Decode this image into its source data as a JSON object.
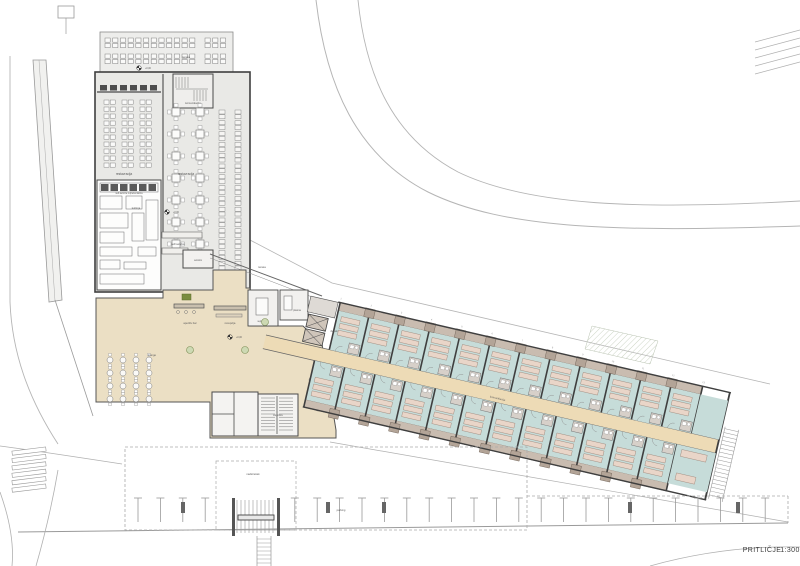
{
  "drawing": {
    "title": "PRITLIČJE",
    "scale": "1:300"
  },
  "labels": {
    "terrace_top": "terasa",
    "stairs": "komunikacija",
    "restaurant_left": "restavracija",
    "restaurant_right": "restavracija",
    "self_service_counter": "self-service reprezentanca",
    "kitchen": "kuhinja",
    "self_service": "self-service",
    "windbreak": "vetrolov",
    "terrace_small": "terasa",
    "meeting_room": "sejna soba",
    "office": "pisarna",
    "elevator": "dvigalo",
    "aperitif_bar": "aperitiv bar",
    "reception": "recepcija",
    "lounge": "lounge",
    "staircase": "stopnišče",
    "corridor": "komunikacija",
    "parking": "parking",
    "canopy": "nadstrešek",
    "elevation_marker": "+0,00"
  },
  "axis_numbers": [
    "1",
    "2",
    "3",
    "4",
    "5",
    "6",
    "7",
    "8",
    "9",
    "10",
    "11",
    "12",
    "13"
  ],
  "wing": {
    "rooms_top": 12,
    "rooms_bottom": 12,
    "beds_per_room": 3,
    "angle_deg": 13,
    "room_width": 31
  },
  "colors": {
    "wall": "#3f3f3f",
    "line": "#b0b0b0",
    "hall_floor": "#e9e9e6",
    "terrace_floor": "#ededeb",
    "lobby": "#ebdfc4",
    "corridor": "#eddbb6",
    "room": "#c6dcd9",
    "bed": "#e9d5c8",
    "bed_stroke": "#9b8477",
    "balcony": "#c9bcb0",
    "balcony_block": "#b3a497",
    "pod": "#d7d0c9",
    "planter_fill": "#cdd9b3",
    "planter_stroke": "#7d8f56",
    "dark": "#555555"
  }
}
